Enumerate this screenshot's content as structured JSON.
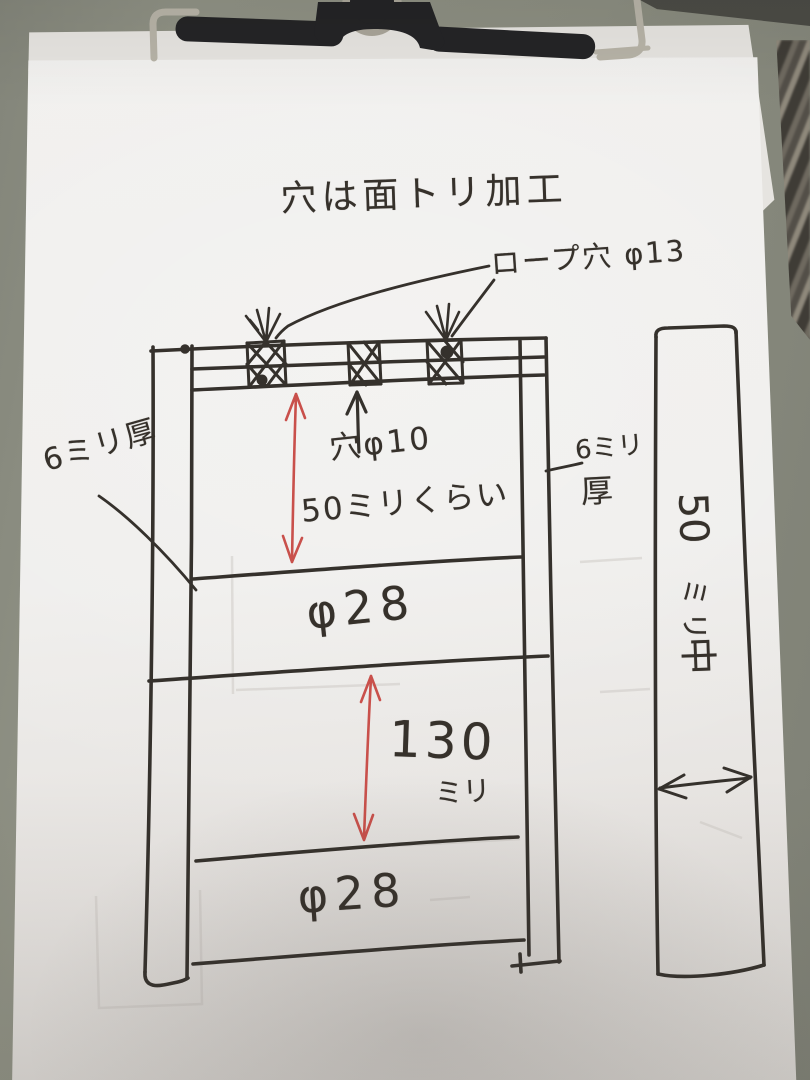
{
  "photo": {
    "board_color": "#8b8d80",
    "paper_color": "#efeeec",
    "ink_color": "#36312b",
    "red_ink_color": "#c9504b",
    "clip_body_color": "#242426",
    "clip_wire_color": "#b7b3a7"
  },
  "drawing": {
    "title": "穴は面トリ加工",
    "rope_hole_label": "ロープ穴 φ13",
    "hole_spec_line1": "穴φ10",
    "hole_spec_line2": "50ミリくらい",
    "rung1_diameter": "φ28",
    "spacing_value": "130",
    "spacing_unit": "ミリ",
    "rung2_diameter": "φ28",
    "left_thickness": "6ミリ厚",
    "right_thickness_line1": "6ミリ",
    "right_thickness_line2": "厚",
    "bar_width_value": "50",
    "bar_width_unit": "ミリ",
    "bar_center_mark": "中"
  }
}
